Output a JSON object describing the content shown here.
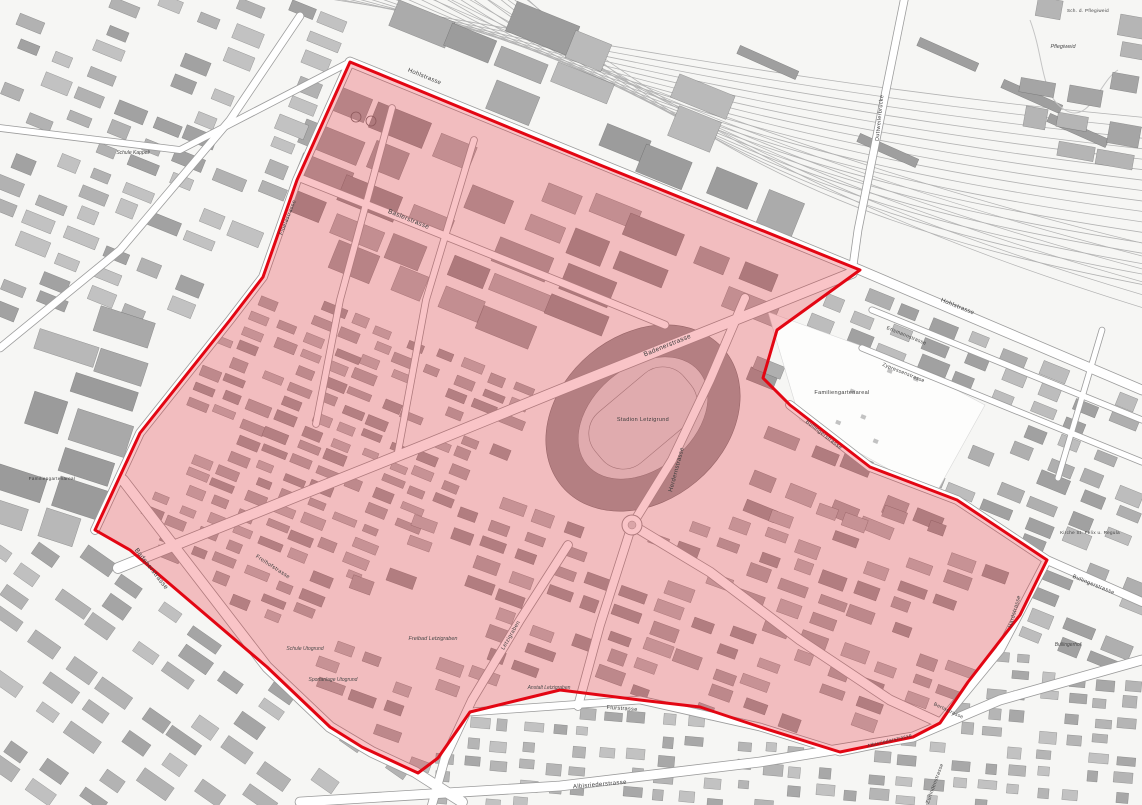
{
  "map": {
    "type": "city-plan",
    "city_area": "Zürich Letzi / Letzigrund district plan",
    "colors": {
      "background": "#f6f6f4",
      "building_dark": "#9a9a9a",
      "building_mid": "#b2b2b2",
      "building_light": "#c6c6c6",
      "road_fill": "#ffffff",
      "road_casing": "#9c9c9c",
      "railway": "#b3b3b3",
      "zone_stroke": "#e30613",
      "zone_fill": "rgba(232,28,38,0.26)",
      "label_color": "#3d3d3d"
    },
    "labels": [
      {
        "id": "stadion-letzigrund",
        "t": "Stadion Letzigrund",
        "x": 643,
        "y": 421,
        "r": 0,
        "s": 5.5,
        "i": 0
      },
      {
        "id": "badenerstrasse-1",
        "t": "Badenerstrasse",
        "x": 668,
        "y": 347,
        "r": -22,
        "s": 6.5,
        "i": 0
      },
      {
        "id": "badenerstrasse-2",
        "t": "Badenerstrasse",
        "x": 150,
        "y": 570,
        "r": 52,
        "s": 6.5,
        "i": 0
      },
      {
        "id": "baslerstrasse",
        "t": "Baslerstrasse",
        "x": 408,
        "y": 221,
        "r": 22,
        "s": 6.5,
        "i": 0
      },
      {
        "id": "hohlstrasse-1",
        "t": "Hohlstrasse",
        "x": 424,
        "y": 78,
        "r": 22,
        "s": 6,
        "i": 0
      },
      {
        "id": "hohlstrasse-2",
        "t": "Hohlstrasse",
        "x": 957,
        "y": 308,
        "r": 22,
        "s": 6,
        "i": 0
      },
      {
        "id": "herdernstrasse",
        "t": "Herdernstrasse",
        "x": 678,
        "y": 470,
        "r": -75,
        "s": 6,
        "i": 0
      },
      {
        "id": "bullingerstrasse-1",
        "t": "Bullingerstrasse",
        "x": 823,
        "y": 436,
        "r": 38,
        "s": 5.5,
        "i": 0
      },
      {
        "id": "bullingerstrasse-2",
        "t": "Bullingerstrasse",
        "x": 1093,
        "y": 586,
        "r": 22,
        "s": 5.5,
        "i": 0
      },
      {
        "id": "hardstrasse",
        "t": "Hardstrasse",
        "x": 1016,
        "y": 612,
        "r": -74,
        "s": 5.5,
        "i": 0
      },
      {
        "id": "fluelastrasse",
        "t": "Flüelastrasse",
        "x": 289,
        "y": 218,
        "r": -68,
        "s": 5.5,
        "i": 0
      },
      {
        "id": "familiengartenareal-1",
        "t": "Familiengartenareal",
        "x": 842,
        "y": 394,
        "r": 0,
        "s": 5.5,
        "i": 0
      },
      {
        "id": "familiengartenareal-2",
        "t": "Familiengartenareal",
        "x": 52,
        "y": 480,
        "r": 0,
        "s": 4.5,
        "i": 0
      },
      {
        "id": "flurstrasse",
        "t": "Flurstrasse",
        "x": 622,
        "y": 710,
        "r": 4,
        "s": 5.5,
        "i": 0
      },
      {
        "id": "albisriederstrasse-1",
        "t": "Albisriederstrasse",
        "x": 600,
        "y": 786,
        "r": -5,
        "s": 6,
        "i": 0
      },
      {
        "id": "albisriederstrasse-2",
        "t": "Albisriederstrasse",
        "x": 890,
        "y": 742,
        "r": -14,
        "s": 5,
        "i": 0
      },
      {
        "id": "letzigraben",
        "t": "Letzigraben",
        "x": 512,
        "y": 636,
        "r": -60,
        "s": 5.5,
        "i": 0
      },
      {
        "id": "freibad-letzigraben",
        "t": "Freibad Letzigraben",
        "x": 433,
        "y": 640,
        "r": 0,
        "s": 5.5,
        "i": 1
      },
      {
        "id": "schule-utogrund",
        "t": "Schule Utogrund",
        "x": 305,
        "y": 650,
        "r": 0,
        "s": 5,
        "i": 1
      },
      {
        "id": "sportanlage-utogrund",
        "t": "Sportanlage Utogrund",
        "x": 333,
        "y": 681,
        "r": 0,
        "s": 5,
        "i": 1
      },
      {
        "id": "anstalt-letzigraben",
        "t": "Anstalt Letzigraben",
        "x": 549,
        "y": 689,
        "r": 0,
        "s": 5,
        "i": 1
      },
      {
        "id": "duttweilerbruecke",
        "t": "Duttweilerbrücke",
        "x": 881,
        "y": 118,
        "r": -84,
        "s": 5.5,
        "i": 0
      },
      {
        "id": "pflegiweid",
        "t": "Pflegiweid",
        "x": 1063,
        "y": 48,
        "r": 0,
        "s": 5.5,
        "i": 1
      },
      {
        "id": "sch-d-pflegiweid",
        "t": "Sch. d. Pflegiweid",
        "x": 1088,
        "y": 12,
        "r": 0,
        "s": 4.5,
        "i": 0
      },
      {
        "id": "bullingerhof",
        "t": "Bullingerhof",
        "x": 1068,
        "y": 646,
        "r": 0,
        "s": 5,
        "i": 1
      },
      {
        "id": "kirche-st-felix-u-regula",
        "t": "Kirche St. Felix u. Regula",
        "x": 1090,
        "y": 534,
        "r": 0,
        "s": 4.5,
        "i": 0
      },
      {
        "id": "erismannstrasse",
        "t": "Erismannstrasse",
        "x": 906,
        "y": 337,
        "r": 22,
        "s": 5,
        "i": 0
      },
      {
        "id": "zypressenstrasse",
        "t": "Zypressenstrasse",
        "x": 903,
        "y": 374,
        "r": 22,
        "s": 5,
        "i": 0
      },
      {
        "id": "freihofstrasse",
        "t": "Freihofstrasse",
        "x": 272,
        "y": 568,
        "r": 33,
        "s": 5.5,
        "i": 0
      },
      {
        "id": "schule-kappeli",
        "t": "Schule Kappeli",
        "x": 133,
        "y": 154,
        "r": 0,
        "s": 5,
        "i": 1
      },
      {
        "id": "bertastrasse",
        "t": "Bertastrasse",
        "x": 948,
        "y": 712,
        "r": 25,
        "s": 5,
        "i": 0
      },
      {
        "id": "zurlindenstrasse",
        "t": "Zurlindenstrasse",
        "x": 936,
        "y": 784,
        "r": -70,
        "s": 5,
        "i": 0
      }
    ],
    "zone": {
      "name": "highlighted planning perimeter",
      "points": "350,62 600,165 860,270 777,330 763,378 790,405 870,467 957,500 1047,560 1020,615 968,682 940,723 913,737 840,752 760,727 700,707 640,700 560,690 470,712 438,758 418,773 362,747 330,727 267,667 130,550 95,530 140,433 230,320 263,277 297,180"
    },
    "stadium": {
      "cx": 643,
      "cy": 418,
      "rot": -40,
      "rx_outer": 106,
      "ry_outer": 83,
      "rx_inner": 73,
      "ry_inner": 51
    },
    "roundabout": {
      "cx": 632,
      "cy": 525,
      "r": 10
    },
    "roads": [
      {
        "n": "hohlstrasse",
        "d": "M350,62 L640,180 L860,270 L1142,390",
        "w": 9
      },
      {
        "n": "fluelastrasse",
        "d": "M350,62 L297,180 L263,277 L230,320 L140,433 L95,530",
        "w": 8
      },
      {
        "n": "baslerstrasse",
        "d": "M300,178 L408,221 L560,282 L665,325",
        "w": 7
      },
      {
        "n": "badenerstrasse",
        "d": "M852,273 L700,334 L560,390 L430,443 L300,495 L118,568",
        "w": 10
      },
      {
        "n": "badenerstrasse-sw",
        "d": "M123,480 L200,580 L267,667 L330,727 L372,752 L415,772 L462,802",
        "w": 10
      },
      {
        "n": "herdernstrasse",
        "d": "M745,298 L710,380 L672,460 L632,525 L600,625 L578,706",
        "w": 8
      },
      {
        "n": "badenerstrasse-se",
        "d": "M632,525 L710,572 L800,640 L890,700 L940,723",
        "w": 9
      },
      {
        "n": "bullingerstrasse",
        "d": "M790,405 L870,467 L957,500 L1047,560 L1142,602",
        "w": 8
      },
      {
        "n": "hardstrasse",
        "d": "M1047,560 L1000,650 L940,723",
        "w": 8
      },
      {
        "n": "flurstrasse",
        "d": "M470,712 L640,700 L760,727 L840,752 L913,737",
        "w": 7
      },
      {
        "n": "albisriederstrasse",
        "d": "M300,802 L560,786 L760,762 L913,737 L1000,700 L1142,660",
        "w": 9
      },
      {
        "n": "letzigraben-strasse",
        "d": "M568,545 L520,620 L472,700 L445,758 L432,805",
        "w": 8
      },
      {
        "n": "duttweilerbruecke-road",
        "d": "M905,-4 L880,120 L858,230 L852,273",
        "w": 7
      },
      {
        "n": "quartierstrasse-west-1",
        "d": "M392,108 L340,300 L316,424",
        "w": 6
      },
      {
        "n": "quartierstrasse-west-2",
        "d": "M474,140 L426,300 L398,452",
        "w": 6
      },
      {
        "n": "erismannstrasse-road",
        "d": "M872,310 L1142,420",
        "w": 5.5
      },
      {
        "n": "zypressenstrasse-road",
        "d": "M862,348 L1142,462",
        "w": 5.5
      },
      {
        "n": "quartierstrasse-ost",
        "d": "M1102,330 L1058,478",
        "w": 5
      },
      {
        "n": "kappeli-strasse-nw1",
        "d": "M0,348 L120,250 L230,120 L300,16",
        "w": 7
      },
      {
        "n": "kappeli-strasse-nw2",
        "d": "M0,128 L180,150 L350,62",
        "w": 6
      }
    ],
    "railway": {
      "main_lines": 17,
      "branch_lines": 6
    },
    "districts": [
      {
        "poly": [
          [
            300,
            85
          ],
          [
            840,
            268
          ],
          [
            790,
            330
          ],
          [
            600,
            375
          ],
          [
            430,
            330
          ],
          [
            275,
            270
          ]
        ],
        "angle": 22,
        "cw": 56,
        "ch": 36,
        "bw": [
          30,
          64
        ],
        "bh": [
          16,
          30
        ],
        "p": 0.82,
        "pal": [
          "#9a9a9a",
          "#a8a8a8",
          "#b6b6b6"
        ]
      },
      {
        "poly": [
          [
            270,
            285
          ],
          [
            560,
            385
          ],
          [
            520,
            450
          ],
          [
            420,
            520
          ],
          [
            300,
            640
          ],
          [
            140,
            540
          ],
          [
            230,
            325
          ]
        ],
        "angle": 22,
        "cw": 30,
        "ch": 17,
        "bw": [
          14,
          26
        ],
        "bh": [
          7,
          11
        ],
        "p": 0.82,
        "pal": [
          "#a3a3a3",
          "#b0b0b0",
          "#bcbcbc"
        ]
      },
      {
        "poly": [
          [
            755,
            345
          ],
          [
            790,
            405
          ],
          [
            870,
            467
          ],
          [
            950,
            505
          ],
          [
            900,
            560
          ],
          [
            700,
            500
          ],
          [
            700,
            420
          ]
        ],
        "angle": 22,
        "cw": 42,
        "ch": 25,
        "bw": [
          22,
          36
        ],
        "bh": [
          12,
          20
        ],
        "p": 0.75,
        "pal": [
          "#9e9e9e",
          "#adadad",
          "#bababa"
        ]
      },
      {
        "poly": [
          [
            560,
            480
          ],
          [
            700,
            505
          ],
          [
            960,
            515
          ],
          [
            1040,
            560
          ],
          [
            1000,
            650
          ],
          [
            940,
            720
          ],
          [
            840,
            748
          ],
          [
            760,
            725
          ],
          [
            640,
            700
          ],
          [
            470,
            710
          ],
          [
            420,
            768
          ],
          [
            350,
            742
          ],
          [
            300,
            648
          ],
          [
            420,
            525
          ]
        ],
        "angle": 20,
        "cw": 37,
        "ch": 21,
        "bw": [
          16,
          30
        ],
        "bh": [
          9,
          14
        ],
        "p": 0.72,
        "pal": [
          "#a0a0a0",
          "#aeaeae",
          "#bcbcbc"
        ]
      },
      {
        "poly": [
          [
            0,
            0
          ],
          [
            345,
            0
          ],
          [
            345,
            60
          ],
          [
            263,
            277
          ],
          [
            230,
            318
          ],
          [
            0,
            328
          ]
        ],
        "angle": 22,
        "cw": 40,
        "ch": 23,
        "bw": [
          18,
          34
        ],
        "bh": [
          10,
          16
        ],
        "p": 0.72,
        "pal": [
          "#a2a2a2",
          "#b2b2b2",
          "#c2c2c2"
        ]
      },
      {
        "poly": [
          [
            0,
            332
          ],
          [
            228,
            322
          ],
          [
            140,
            433
          ],
          [
            95,
            528
          ],
          [
            0,
            538
          ]
        ],
        "angle": 18,
        "cw": 62,
        "ch": 36,
        "bw": [
          34,
          70
        ],
        "bh": [
          18,
          34
        ],
        "p": 0.72,
        "pal": [
          "#9b9b9b",
          "#a9a9a9",
          "#b8b8b8"
        ]
      },
      {
        "poly": [
          [
            0,
            542
          ],
          [
            92,
            532
          ],
          [
            128,
            552
          ],
          [
            265,
            668
          ],
          [
            328,
            728
          ],
          [
            412,
            772
          ],
          [
            428,
            805
          ],
          [
            0,
            805
          ]
        ],
        "angle": 35,
        "cw": 45,
        "ch": 25,
        "bw": [
          20,
          38
        ],
        "bh": [
          10,
          16
        ],
        "p": 0.66,
        "pal": [
          "#a5a5a5",
          "#b3b3b3",
          "#c0c0c0"
        ]
      },
      {
        "poly": [
          [
            430,
            805
          ],
          [
            418,
            772
          ],
          [
            468,
            714
          ],
          [
            640,
            702
          ],
          [
            758,
            728
          ],
          [
            838,
            753
          ],
          [
            910,
            739
          ],
          [
            938,
            725
          ],
          [
            1000,
            655
          ],
          [
            1142,
            675
          ],
          [
            1142,
            805
          ]
        ],
        "angle": 5,
        "cw": 27,
        "ch": 19,
        "bw": [
          10,
          20
        ],
        "bh": [
          8,
          12
        ],
        "p": 0.8,
        "pal": [
          "#a8a8a8",
          "#b5b5b5",
          "#c2c2c2"
        ]
      },
      {
        "poly": [
          [
            862,
            272
          ],
          [
            1142,
            392
          ],
          [
            1142,
            668
          ],
          [
            1002,
            648
          ],
          [
            1048,
            560
          ],
          [
            955,
            500
          ],
          [
            868,
            466
          ],
          [
            790,
            404
          ],
          [
            764,
            377
          ],
          [
            778,
            330
          ]
        ],
        "angle": 22,
        "cw": 39,
        "ch": 21,
        "bw": [
          18,
          32
        ],
        "bh": [
          10,
          15
        ],
        "p": 0.76,
        "pal": [
          "#a1a1a1",
          "#afafaf",
          "#bdbdbd"
        ]
      },
      {
        "poly": [
          [
            1005,
            0
          ],
          [
            1142,
            0
          ],
          [
            1142,
            175
          ],
          [
            1040,
            150
          ],
          [
            1005,
            70
          ]
        ],
        "angle": 10,
        "cw": 45,
        "ch": 27,
        "bw": [
          22,
          40
        ],
        "bh": [
          14,
          22
        ],
        "p": 0.62,
        "pal": [
          "#a5a5a5",
          "#b5b5b5"
        ]
      },
      {
        "poly": [
          [
            360,
            5
          ],
          [
            640,
            30
          ],
          [
            870,
            262
          ],
          [
            600,
            160
          ]
        ],
        "angle": 22,
        "cw": 58,
        "ch": 38,
        "bw": [
          36,
          80
        ],
        "bh": [
          20,
          38
        ],
        "p": 0.72,
        "pal": [
          "#9c9c9c",
          "#ababab",
          "#bababa"
        ]
      }
    ],
    "masks": [
      {
        "type": "circle",
        "cx": 643,
        "cy": 418,
        "r": 118,
        "f": 0
      },
      {
        "type": "circle",
        "cx": 632,
        "cy": 525,
        "r": 22,
        "f": 0
      },
      {
        "type": "circle",
        "cx": 425,
        "cy": 632,
        "r": 58,
        "f": 0.15
      },
      {
        "type": "poly",
        "pts": [
          [
            768,
            315
          ],
          [
            965,
            395
          ],
          [
            905,
            490
          ],
          [
            775,
            400
          ]
        ],
        "f": 0.04
      },
      {
        "type": "circle",
        "cx": 1063,
        "cy": 52,
        "r": 42,
        "f": 0.08
      }
    ],
    "garden": {
      "pts": "768,312 900,360 985,405 935,495 800,420",
      "huts": 9
    },
    "tanks": [
      {
        "cx": 356,
        "cy": 117,
        "r": 5
      },
      {
        "cx": 371,
        "cy": 121,
        "r": 5
      }
    ]
  }
}
